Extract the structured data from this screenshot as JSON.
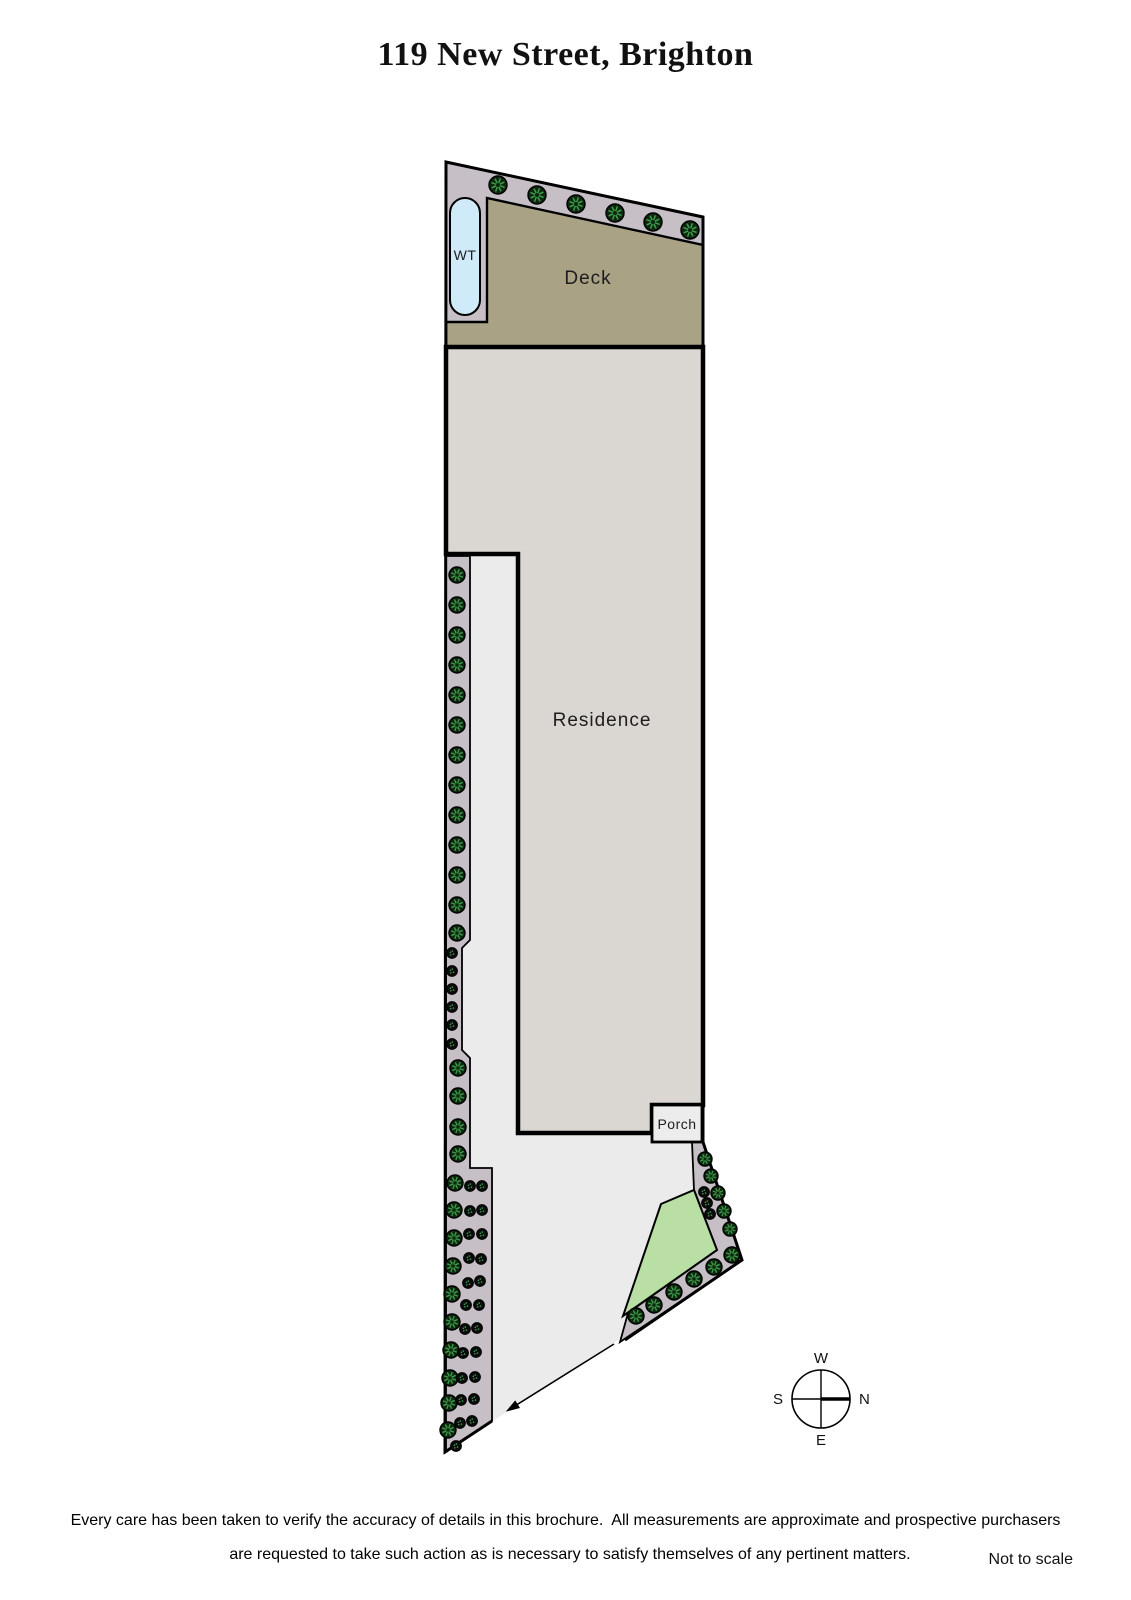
{
  "title": "119 New Street, Brighton",
  "footer": {
    "disclaimer_line1": "Every care has been taken to verify the accuracy of details in this brochure.  All measurements are approximate and prospective purchasers",
    "disclaimer_line2": "are requested to take such action as is necessary to satisfy themselves of any pertinent matters.",
    "scale_note": "Not to scale"
  },
  "labels": {
    "deck": "Deck",
    "residence": "Residence",
    "porch": "Porch",
    "water_tank": "WT"
  },
  "compass": {
    "west": "W",
    "north": "N",
    "east": "E",
    "south": "S",
    "cx": 821,
    "cy": 1399,
    "r": 29
  },
  "colors": {
    "page_bg": "#ffffff",
    "yard": "#ebebeb",
    "garden_bed": "#c6c0c6",
    "deck": "#a9a284",
    "residence": "#dad6d1",
    "porch": "#ececec",
    "lawn": "#b9dfa4",
    "water_tank": "#cfeaf8",
    "outline": "#000000",
    "tree_fill": "#0d280d",
    "tree_spoke": "#3f9e4f",
    "shrub_fill": "#0b0b0b",
    "text": "#1d1d1d"
  },
  "plan": {
    "site_outline": [
      [
        446,
        162
      ],
      [
        703,
        217
      ],
      [
        703,
        1142
      ],
      [
        742,
        1260
      ],
      [
        445,
        1452
      ]
    ],
    "boundary_path": [
      [
        625,
        1340
      ],
      [
        742,
        1260
      ],
      [
        703,
        1142
      ],
      [
        703,
        217
      ],
      [
        446,
        162
      ],
      [
        445,
        1452
      ],
      [
        492,
        1421
      ]
    ],
    "top_bed": [
      [
        446,
        162
      ],
      [
        703,
        217
      ],
      [
        703,
        245
      ],
      [
        487,
        198
      ],
      [
        487,
        322
      ],
      [
        446,
        322
      ]
    ],
    "deck": [
      [
        487,
        198
      ],
      [
        703,
        245
      ],
      [
        703,
        347
      ],
      [
        446,
        347
      ],
      [
        446,
        322
      ],
      [
        487,
        322
      ]
    ],
    "residence": [
      [
        446,
        347
      ],
      [
        703,
        347
      ],
      [
        703,
        1105
      ],
      [
        652,
        1105
      ],
      [
        652,
        1133
      ],
      [
        518,
        1133
      ],
      [
        518,
        554
      ],
      [
        446,
        554
      ]
    ],
    "left_bed": [
      [
        446,
        556
      ],
      [
        470,
        556
      ],
      [
        470,
        940
      ],
      [
        462,
        948
      ],
      [
        462,
        1050
      ],
      [
        470,
        1058
      ],
      [
        470,
        1168
      ],
      [
        492,
        1168
      ],
      [
        492,
        1421
      ],
      [
        446,
        1452
      ]
    ],
    "right_bed": [
      [
        692,
        1142
      ],
      [
        703,
        1142
      ],
      [
        742,
        1260
      ],
      [
        620,
        1342
      ],
      [
        628,
        1313
      ],
      [
        717,
        1250
      ],
      [
        694,
        1190
      ]
    ],
    "lawn": [
      [
        661,
        1204
      ],
      [
        694,
        1190
      ],
      [
        717,
        1250
      ],
      [
        623,
        1316
      ]
    ],
    "porch_rect": {
      "x": 652,
      "y": 1105,
      "w": 50,
      "h": 37
    },
    "water_tank_rect": {
      "x": 450,
      "y": 198,
      "w": 30,
      "h": 117,
      "rx": 15
    },
    "driveway_arrow": {
      "from": [
        614,
        1344
      ],
      "to": [
        510,
        1409
      ]
    },
    "trees": [
      [
        498,
        185,
        9
      ],
      [
        537,
        195,
        9
      ],
      [
        576,
        204,
        9
      ],
      [
        615,
        213,
        9
      ],
      [
        653,
        222,
        9
      ],
      [
        690,
        230,
        9
      ],
      [
        457,
        575,
        8
      ],
      [
        457,
        605,
        8
      ],
      [
        457,
        635,
        8
      ],
      [
        457,
        665,
        8
      ],
      [
        457,
        695,
        8
      ],
      [
        457,
        725,
        8
      ],
      [
        457,
        755,
        8
      ],
      [
        457,
        785,
        8
      ],
      [
        457,
        815,
        8
      ],
      [
        457,
        845,
        8
      ],
      [
        457,
        875,
        8
      ],
      [
        457,
        905,
        8
      ],
      [
        457,
        933,
        8
      ],
      [
        458,
        1068,
        8
      ],
      [
        458,
        1096,
        8
      ],
      [
        458,
        1127,
        8
      ],
      [
        458,
        1154,
        8
      ],
      [
        455,
        1183,
        8
      ],
      [
        454,
        1210,
        8
      ],
      [
        454,
        1238,
        8
      ],
      [
        453,
        1266,
        8
      ],
      [
        452,
        1294,
        8
      ],
      [
        452,
        1322,
        8
      ],
      [
        451,
        1350,
        8
      ],
      [
        450,
        1378,
        8
      ],
      [
        449,
        1403,
        8
      ],
      [
        448,
        1430,
        8
      ],
      [
        705,
        1159,
        7
      ],
      [
        711,
        1176,
        7
      ],
      [
        718,
        1193,
        7
      ],
      [
        724,
        1211,
        7
      ],
      [
        730,
        1229,
        7
      ],
      [
        732,
        1255,
        8
      ],
      [
        714,
        1267,
        8
      ],
      [
        694,
        1279,
        8
      ],
      [
        674,
        1292,
        8
      ],
      [
        654,
        1305,
        8
      ],
      [
        636,
        1316,
        8
      ]
    ],
    "shrubs": [
      [
        452,
        953
      ],
      [
        452,
        971
      ],
      [
        452,
        989
      ],
      [
        452,
        1007
      ],
      [
        452,
        1025
      ],
      [
        452,
        1044
      ],
      [
        470,
        1186
      ],
      [
        482,
        1186
      ],
      [
        470,
        1211
      ],
      [
        482,
        1210
      ],
      [
        469,
        1234
      ],
      [
        482,
        1234
      ],
      [
        469,
        1258
      ],
      [
        481,
        1259
      ],
      [
        468,
        1283
      ],
      [
        480,
        1281
      ],
      [
        466,
        1305
      ],
      [
        479,
        1305
      ],
      [
        465,
        1329
      ],
      [
        477,
        1328
      ],
      [
        463,
        1353
      ],
      [
        476,
        1352
      ],
      [
        462,
        1378
      ],
      [
        475,
        1377
      ],
      [
        461,
        1400
      ],
      [
        474,
        1399
      ],
      [
        460,
        1423
      ],
      [
        472,
        1421
      ],
      [
        456,
        1446
      ],
      [
        704,
        1192
      ],
      [
        707,
        1203
      ],
      [
        710,
        1214
      ]
    ],
    "label_positions": {
      "deck": {
        "x": 588,
        "y": 284,
        "size": 19,
        "ls": 1
      },
      "residence": {
        "x": 602,
        "y": 726,
        "size": 19,
        "ls": 1
      },
      "porch": {
        "x": 677,
        "y": 1129,
        "size": 14,
        "ls": 0.5
      },
      "water_tank": {
        "x": 465,
        "y": 260,
        "size": 14,
        "ls": 0.5
      }
    }
  }
}
